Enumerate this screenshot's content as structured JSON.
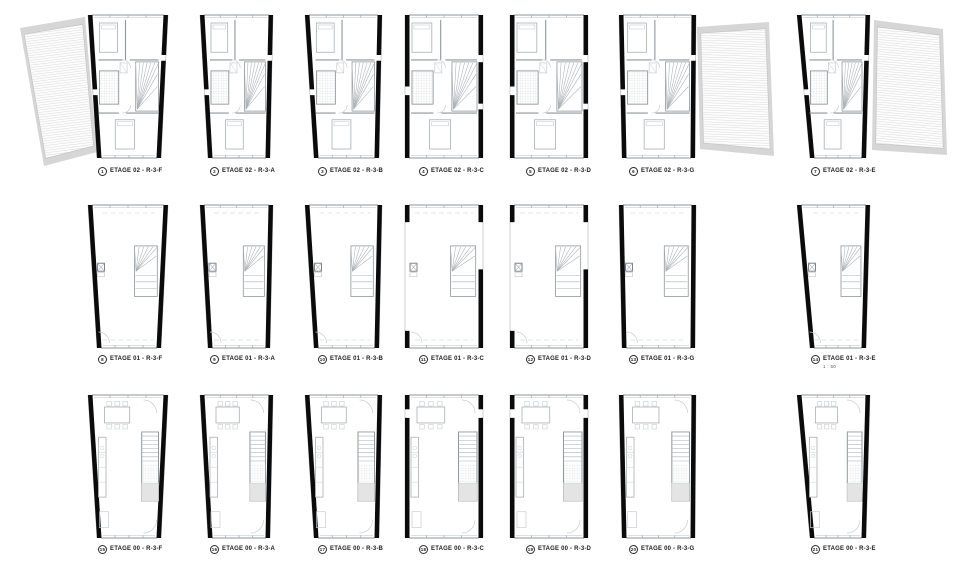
{
  "sheet": {
    "background": "#ffffff",
    "scale_note": "1 : 50",
    "colors": {
      "wall": "#0b0b0b",
      "partition": "#8f969b",
      "light": "#aab0b4",
      "faint": "#c9cdd0",
      "roof_border": "#d6d6d6",
      "roof_edge": "#c2c2c2",
      "text": "#1c1c1c"
    },
    "levels": [
      "ETAGE 02",
      "ETAGE 01",
      "ETAGE 00"
    ],
    "plans": [
      {
        "num": "1",
        "label": "ETAGE 02 - R-3-F"
      },
      {
        "num": "2",
        "label": "ETAGE 02 - R-3-A"
      },
      {
        "num": "3",
        "label": "ETAGE 02 - R-3-B"
      },
      {
        "num": "4",
        "label": "ETAGE 02 - R-3-C"
      },
      {
        "num": "5",
        "label": "ETAGE 02 - R-3-D"
      },
      {
        "num": "6",
        "label": "ETAGE 02 - R-3-G"
      },
      {
        "num": "7",
        "label": "ETAGE 02 - R-3-E"
      },
      {
        "num": "8",
        "label": "ETAGE 01 - R-3-F"
      },
      {
        "num": "9",
        "label": "ETAGE 01 - R-3-A"
      },
      {
        "num": "10",
        "label": "ETAGE 01 - R-3-B"
      },
      {
        "num": "11",
        "label": "ETAGE 01 - R-3-C"
      },
      {
        "num": "12",
        "label": "ETAGE 01 - R-3-D"
      },
      {
        "num": "13",
        "label": "ETAGE 01 - R-3-G"
      },
      {
        "num": "14",
        "label": "ETAGE 01 - R-3-E"
      },
      {
        "num": "15",
        "label": "ETAGE 00 - R-3-F"
      },
      {
        "num": "16",
        "label": "ETAGE 00 - R-3-A"
      },
      {
        "num": "17",
        "label": "ETAGE 00 - R-3-B"
      },
      {
        "num": "18",
        "label": "ETAGE 00 - R-3-C"
      },
      {
        "num": "19",
        "label": "ETAGE 00 - R-3-D"
      },
      {
        "num": "20",
        "label": "ETAGE 00 - R-3-G"
      },
      {
        "num": "21",
        "label": "ETAGE 00 - R-3-E"
      }
    ]
  }
}
